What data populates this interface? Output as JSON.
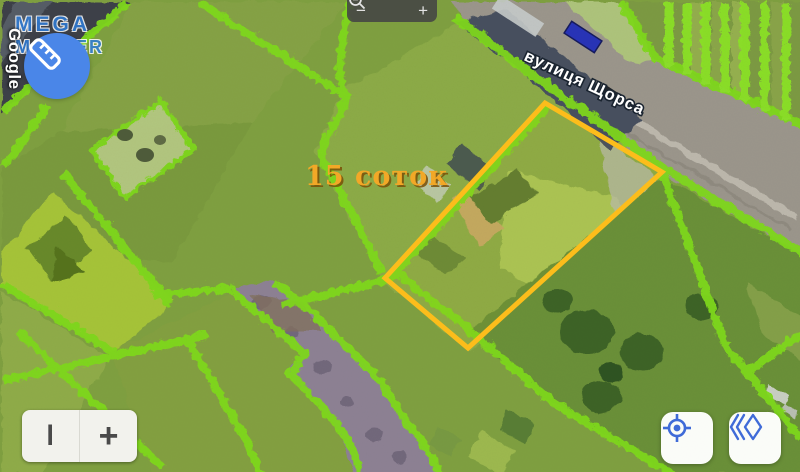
{
  "watermarks": {
    "google": "Google",
    "brand_line1": "MEGA",
    "brand_line2": "MAKLER"
  },
  "map": {
    "street_label": "вулиця Щорса",
    "area_label": "15 соток",
    "colors": {
      "parcel_boundary": "#7FD91C",
      "highlight_outline": "#FCBD1B",
      "area_label": "#F2A827",
      "road": "#9B968C",
      "dirt_path": "#8D8194",
      "accent_blue": "#3F6BD8",
      "ruler_button": "#4A86E8"
    }
  },
  "controls": {
    "zoom_toolbar": {
      "zoom_out_label": "−",
      "zoom_in_label": "+",
      "magnifier_icon": "magnifier"
    },
    "measure_button": {
      "icon": "ruler"
    },
    "bottom_left_control": {
      "left_label": "I",
      "right_label": "+"
    },
    "bottom_right": {
      "locate_icon": "crosshair-target",
      "nav_icon": "double-chevron-diamond"
    }
  }
}
